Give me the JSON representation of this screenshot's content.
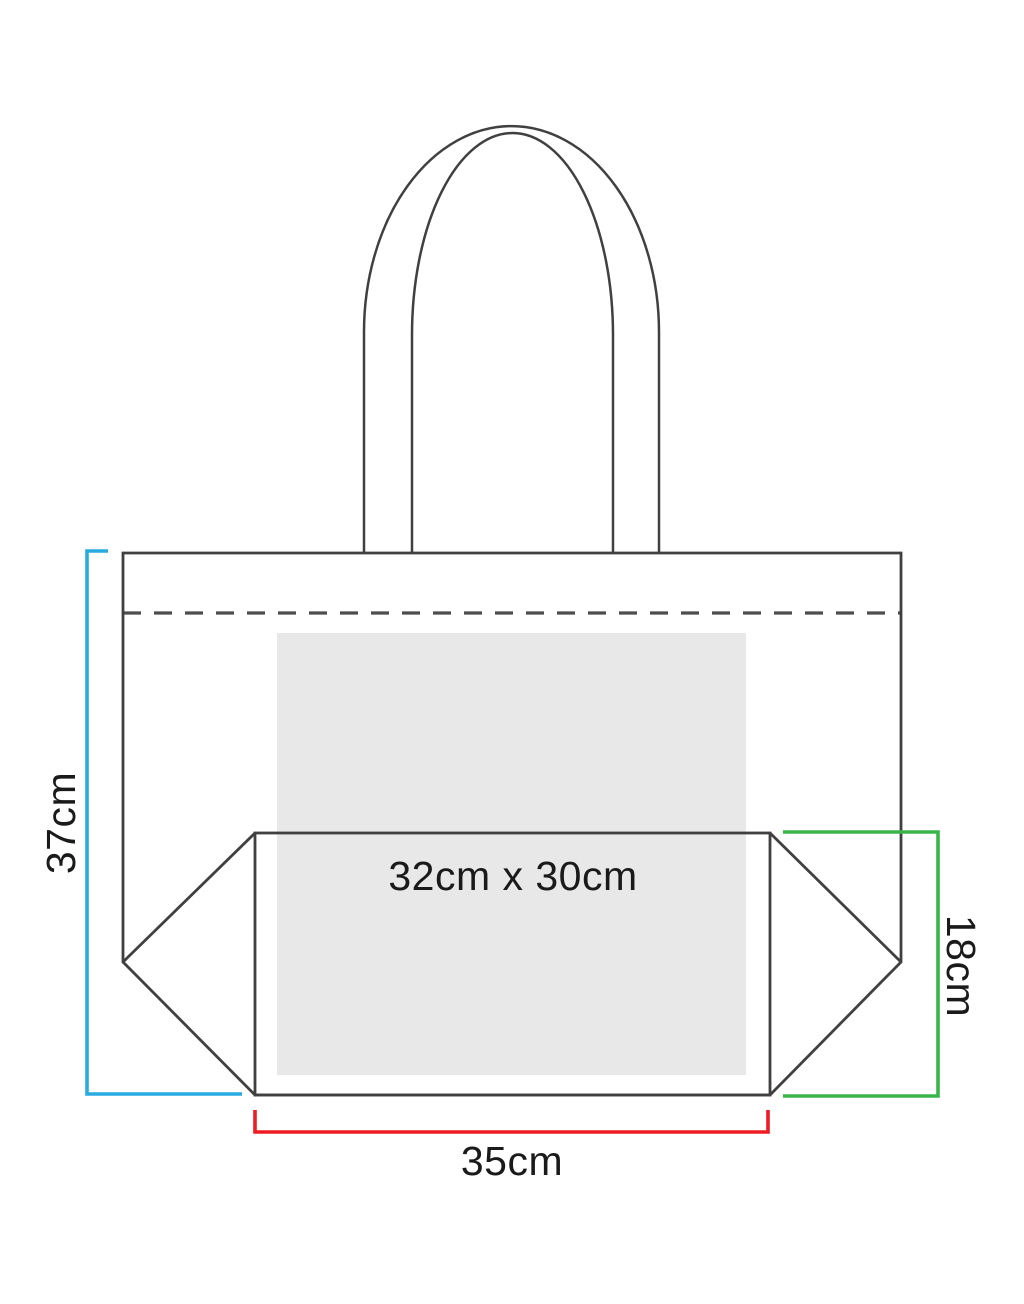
{
  "diagram": {
    "name": "Tote bag dimensions diagram",
    "print_area": {
      "label": "32cm x 30cm",
      "fill": "#e8e8e8"
    },
    "dimensions": {
      "height": {
        "label": "37cm",
        "color": "#29abe2"
      },
      "width": {
        "label": "35cm",
        "color": "#ed1c24"
      },
      "gusset": {
        "label": "18cm",
        "color": "#39b54a"
      }
    },
    "outline_color": "#404040",
    "dashed_line_color": "#4d4d4d",
    "label_color": "#1a1a1a",
    "background": "#ffffff"
  }
}
